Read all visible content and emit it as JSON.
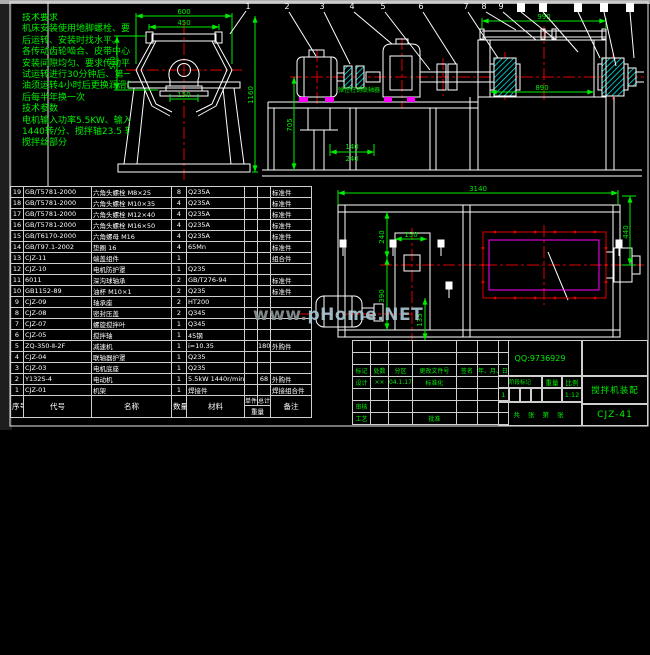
{
  "colors": {
    "line_white": "#ffffff",
    "dim_green": "#00ee00",
    "center_red": "#e00000",
    "magenta": "#ff00ff",
    "cyan": "#00ffff"
  },
  "notes": {
    "lines": [
      "技术要求",
      "机床安装使用地脚螺栓、要求安装",
      "后运转、安装时找水平。",
      "各传动齿轮啮合、皮带中心距等",
      "安装间隙均匀、要求传动平稳有序。",
      "试运转进行30分钟后、第一次换",
      "油须运转4小时后更换润滑油、其",
      "后每半年换一次",
      "技术参数",
      "电机输入功率5.5KW、输入转速",
      "1440转/分、搅拌轴23.5 转/分",
      "搅拌丝部分"
    ]
  },
  "balloons": {
    "items": [
      "1",
      "2",
      "3",
      "4",
      "5",
      "6",
      "7",
      "8",
      "9"
    ]
  },
  "dims": {
    "end": {
      "top": "600",
      "flange": "450",
      "left": "560",
      "height": "1160",
      "hub": "150"
    },
    "side": {
      "pipe": "990",
      "drum": "890",
      "height": "705",
      "a": "140",
      "b": "240",
      "coupling_label": "弹性柱销联轴器"
    },
    "plan": {
      "overall": "3140",
      "right": "440",
      "d1": "240",
      "d2": "150",
      "d3": "390",
      "d4": "135"
    }
  },
  "watermark": {
    "prefix": "www.",
    "main": "pHome.NET"
  },
  "bom": {
    "headers": {
      "seq": "序号",
      "code": "代号",
      "name": "名称",
      "qty": "数量",
      "material": "材料",
      "unit": "单件",
      "total": "总计",
      "weight": "重量",
      "note": "备注"
    },
    "rows": [
      {
        "seq": "19",
        "code": "GB/T5781-2000",
        "name": "六角头螺栓 M8×25",
        "qty": "8",
        "mat": "Q235A",
        "w1": "",
        "w2": "",
        "note": "标准件"
      },
      {
        "seq": "18",
        "code": "GB/T5781-2000",
        "name": "六角头螺栓 M10×35",
        "qty": "4",
        "mat": "Q235A",
        "w1": "",
        "w2": "",
        "note": "标准件"
      },
      {
        "seq": "17",
        "code": "GB/T5781-2000",
        "name": "六角头螺栓 M12×40",
        "qty": "4",
        "mat": "Q235A",
        "w1": "",
        "w2": "",
        "note": "标准件"
      },
      {
        "seq": "16",
        "code": "GB/T5781-2000",
        "name": "六角头螺栓 M16×50",
        "qty": "4",
        "mat": "Q235A",
        "w1": "",
        "w2": "",
        "note": "标准件"
      },
      {
        "seq": "15",
        "code": "GB/T6170-2000",
        "name": "六角螺母 M16",
        "qty": "4",
        "mat": "Q235A",
        "w1": "",
        "w2": "",
        "note": "标准件"
      },
      {
        "seq": "14",
        "code": "GB/T97.1-2002",
        "name": "垫圈 16",
        "qty": "4",
        "mat": "65Mn",
        "w1": "",
        "w2": "",
        "note": "标准件"
      },
      {
        "seq": "13",
        "code": "CJZ-11",
        "name": "端盖组件",
        "qty": "1",
        "mat": "",
        "w1": "",
        "w2": "",
        "note": "组合件"
      },
      {
        "seq": "12",
        "code": "CJZ-10",
        "name": "电机防护罩",
        "qty": "1",
        "mat": "Q235",
        "w1": "",
        "w2": "",
        "note": ""
      },
      {
        "seq": "11",
        "code": "6011",
        "name": "深沟球轴承",
        "qty": "2",
        "mat": "GB/T276-94",
        "w1": "",
        "w2": "",
        "note": "标准件"
      },
      {
        "seq": "10",
        "code": "GB1152-89",
        "name": "油杯 M10×1",
        "qty": "2",
        "mat": "Q235",
        "w1": "",
        "w2": "",
        "note": "标准件"
      },
      {
        "seq": "9",
        "code": "CJZ-09",
        "name": "轴承座",
        "qty": "2",
        "mat": "HT200",
        "w1": "",
        "w2": "",
        "note": ""
      },
      {
        "seq": "8",
        "code": "CJZ-08",
        "name": "密封压盖",
        "qty": "2",
        "mat": "Q345",
        "w1": "",
        "w2": "",
        "note": ""
      },
      {
        "seq": "7",
        "code": "CJZ-07",
        "name": "螺旋搅拌叶",
        "qty": "1",
        "mat": "Q345",
        "w1": "",
        "w2": "",
        "note": ""
      },
      {
        "seq": "6",
        "code": "CJZ-05",
        "name": "搅拌轴",
        "qty": "1",
        "mat": "45钢",
        "w1": "",
        "w2": "",
        "note": ""
      },
      {
        "seq": "5",
        "code": "ZQ-350-Ⅱ-2F",
        "name": "减速机",
        "qty": "1",
        "mat": "i=10.35",
        "w1": "",
        "w2": "180",
        "note": "外购件"
      },
      {
        "seq": "4",
        "code": "CJZ-04",
        "name": "联轴器护罩",
        "qty": "1",
        "mat": "Q235",
        "w1": "",
        "w2": "",
        "note": ""
      },
      {
        "seq": "3",
        "code": "CJZ-03",
        "name": "电机底座",
        "qty": "1",
        "mat": "Q235",
        "w1": "",
        "w2": "",
        "note": ""
      },
      {
        "seq": "2",
        "code": "Y132S-4",
        "name": "电动机",
        "qty": "1",
        "mat": "5.5kW 1440r/min",
        "w1": "",
        "w2": "68",
        "note": "外购件"
      },
      {
        "seq": "1",
        "code": "CJZ-01",
        "name": "机架",
        "qty": "1",
        "mat": "焊接件",
        "w1": "",
        "w2": "",
        "note": "焊接组合件"
      }
    ]
  },
  "titleblock": {
    "qq": "QQ:9736929",
    "title": "搅拌机装配",
    "number": "CJZ-41",
    "labels": {
      "mark": "标记",
      "count": "处数",
      "zone": "分区",
      "doc": "更改文件号",
      "sign": "签名",
      "date": "年、月、日",
      "design": "设计",
      "standard": "标准化",
      "check": "审核",
      "process": "工艺",
      "approve": "批准",
      "stage": "阶段标记",
      "weight": "重量",
      "scale": "比例"
    },
    "values": {
      "design_sign": "××",
      "design_date": "04.1.17",
      "stage_value": "1",
      "scale_value": "1:12",
      "sheets": "共  张  第  张"
    }
  }
}
